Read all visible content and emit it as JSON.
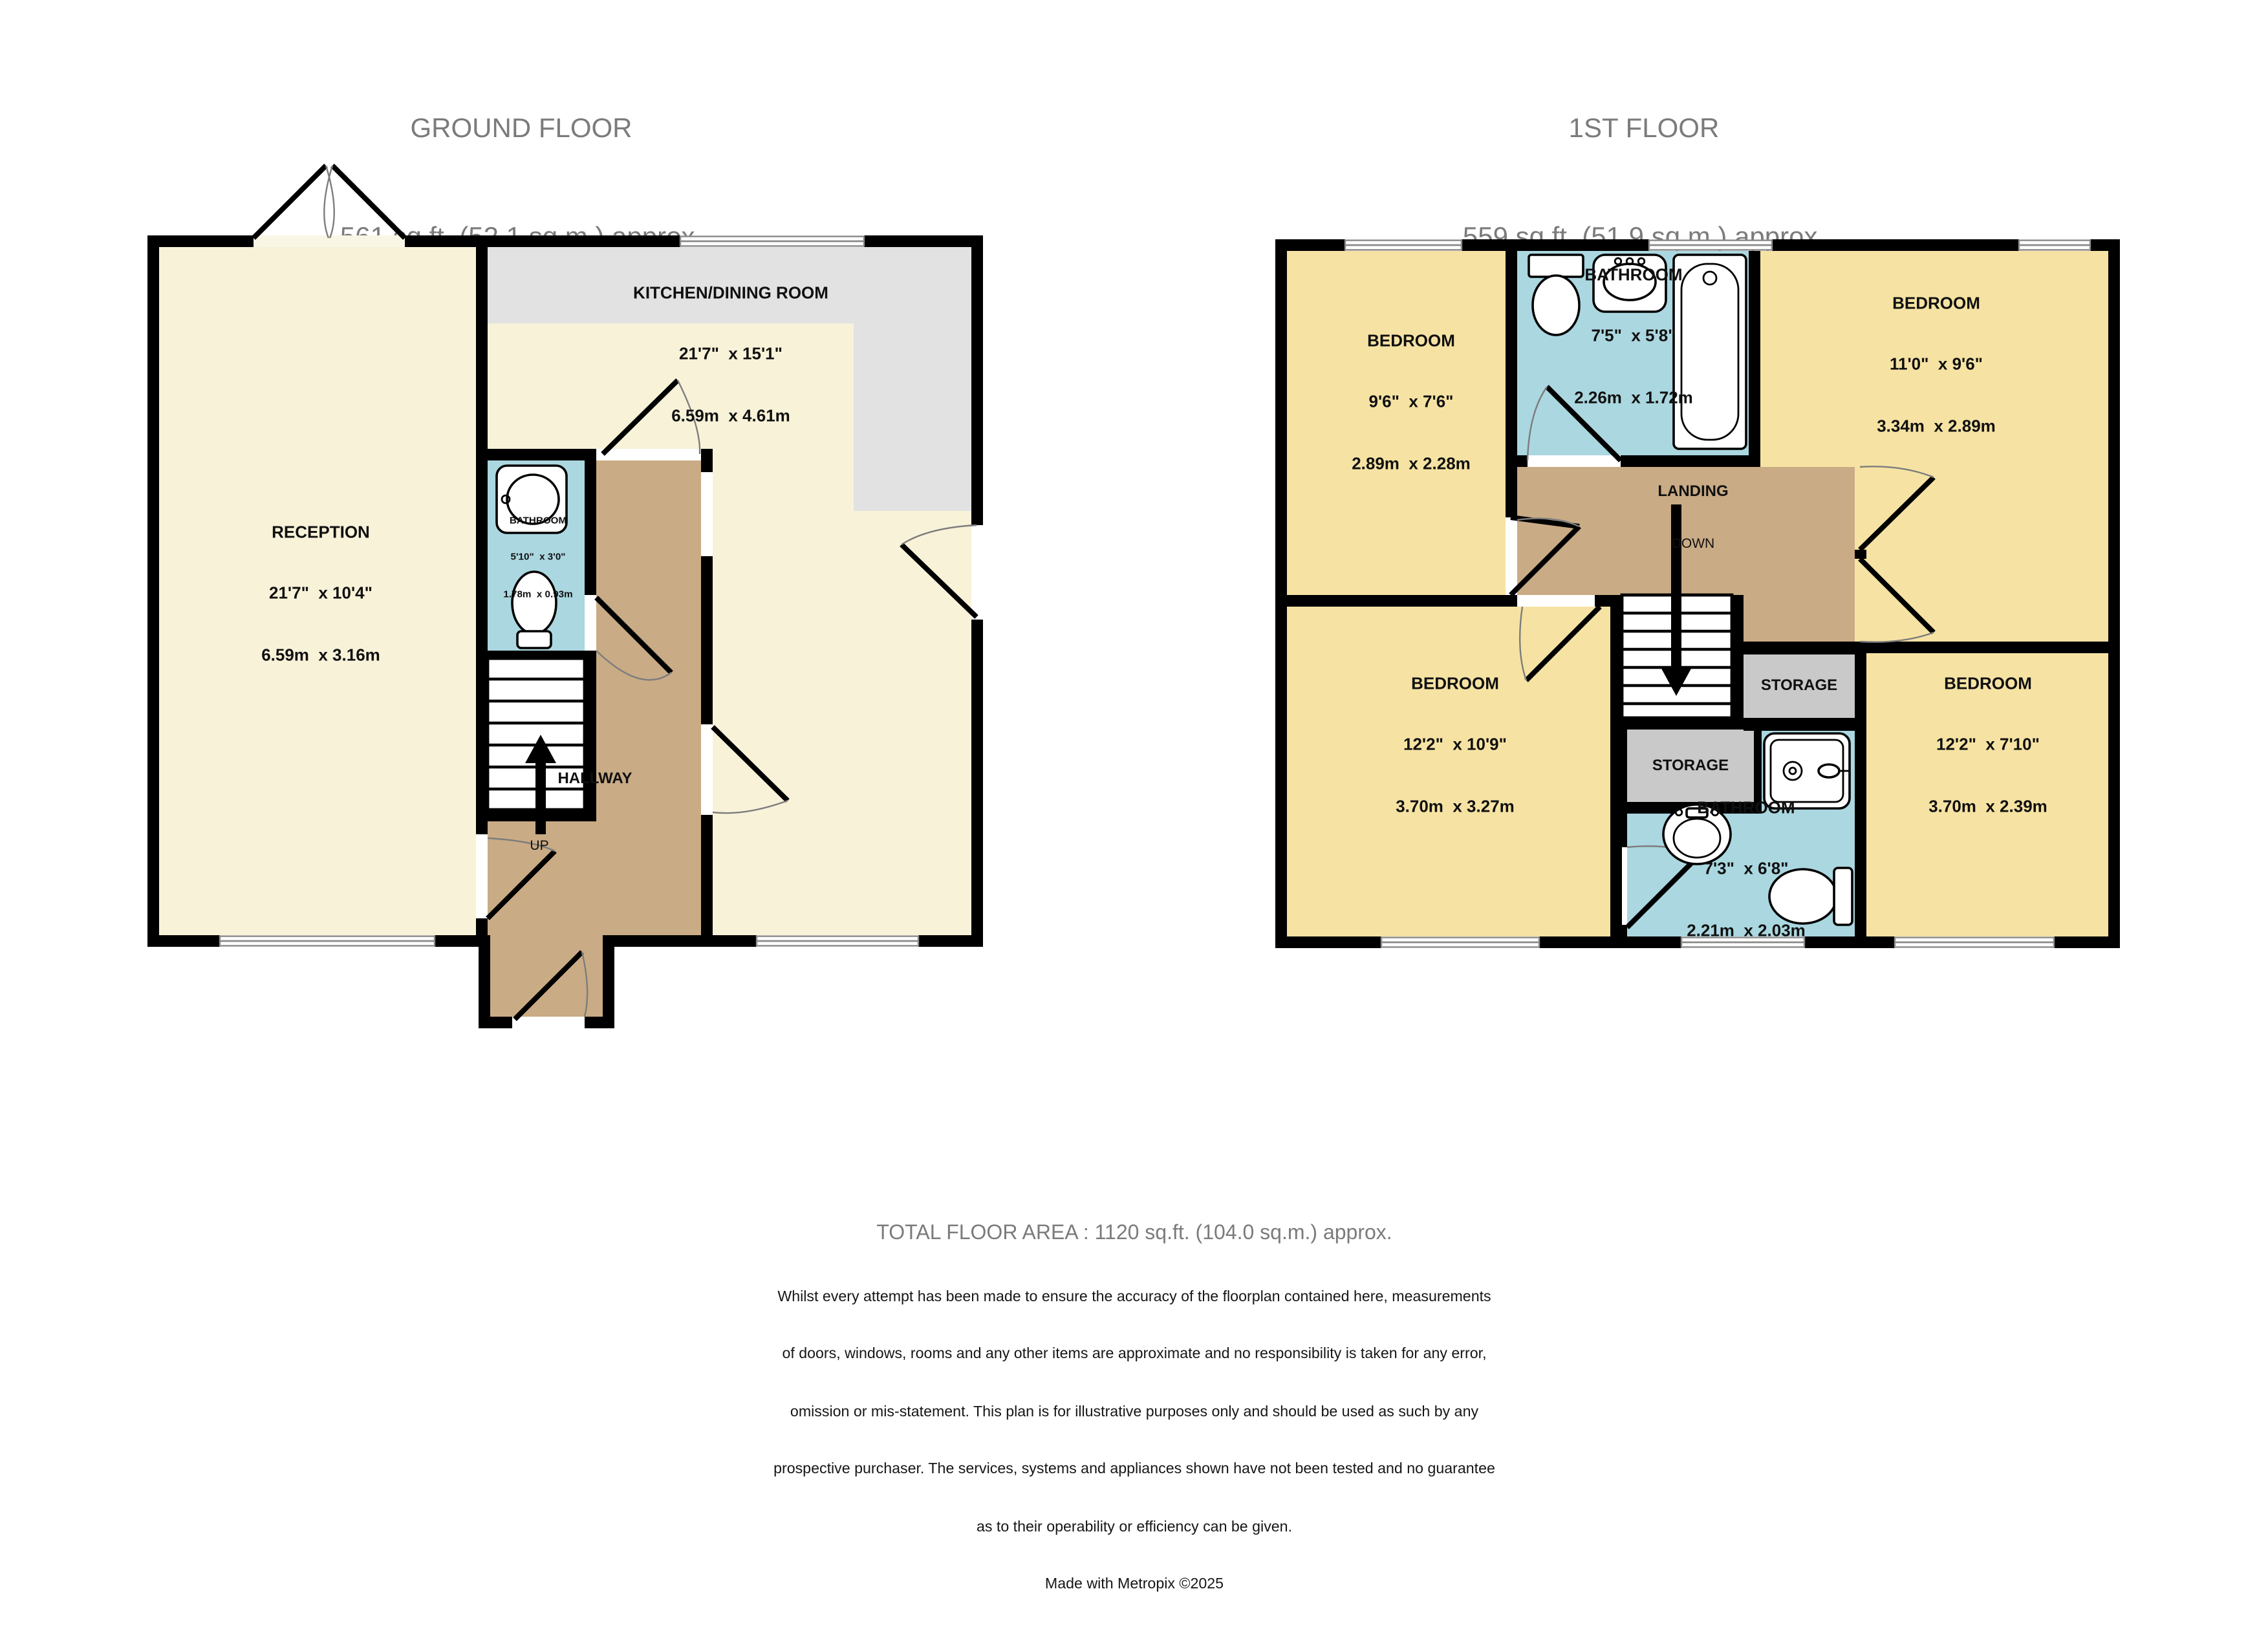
{
  "colors": {
    "wall": "#000000",
    "cream": "#f8f2d9",
    "cream-light": "#faf6e5",
    "yellow": "#f6e3a3",
    "blue": "#abd7e0",
    "tan": "#c9ab85",
    "storage-gray": "#c9c9c9",
    "counter-gray": "#e2e2e2",
    "title-gray": "#7b7b7b"
  },
  "ground_floor": {
    "title": "GROUND FLOOR",
    "subtitle": "561 sq.ft. (52.1 sq.m.) approx.",
    "reception": {
      "name": "RECEPTION",
      "dims_imperial": "21'7\"  x 10'4\"",
      "dims_metric": "6.59m  x 3.16m"
    },
    "kitchen": {
      "name": "KITCHEN/DINING ROOM",
      "dims_imperial": "21'7\"  x 15'1\"",
      "dims_metric": "6.59m  x 4.61m"
    },
    "bathroom": {
      "name": "BATHROOM",
      "dims_imperial": "5'10\"  x 3'0\"",
      "dims_metric": "1.78m  x 0.93m"
    },
    "hallway": {
      "name": "HALLWAY"
    },
    "stairs_label": "UP"
  },
  "first_floor": {
    "title": "1ST FLOOR",
    "subtitle": "559 sq.ft. (51.9 sq.m.) approx.",
    "bedroom_top_left": {
      "name": "BEDROOM",
      "dims_imperial": "9'6\"  x 7'6\"",
      "dims_metric": "2.89m  x 2.28m"
    },
    "bathroom_top": {
      "name": "BATHROOM",
      "dims_imperial": "7'5\"  x 5'8\"",
      "dims_metric": "2.26m  x 1.72m"
    },
    "bedroom_top_right": {
      "name": "BEDROOM",
      "dims_imperial": "11'0\"  x 9'6\"",
      "dims_metric": "3.34m  x 2.89m"
    },
    "landing": {
      "name": "LANDING",
      "stairs_label": "DOWN"
    },
    "bedroom_bottom_left": {
      "name": "BEDROOM",
      "dims_imperial": "12'2\"  x 10'9\"",
      "dims_metric": "3.70m  x 3.27m"
    },
    "bedroom_bottom_right": {
      "name": "BEDROOM",
      "dims_imperial": "12'2\"  x 7'10\"",
      "dims_metric": "3.70m  x 2.39m"
    },
    "storage_upper": {
      "name": "STORAGE"
    },
    "storage_lower": {
      "name": "STORAGE"
    },
    "bathroom_bottom": {
      "name": "BATHROOM",
      "dims_imperial": "7'3\"  x 6'8\"",
      "dims_metric": "2.21m  x 2.03m"
    }
  },
  "footer": {
    "total_area": "TOTAL FLOOR AREA : 1120 sq.ft. (104.0 sq.m.) approx.",
    "disclaimer_lines": [
      "Whilst every attempt has been made to ensure the accuracy of the floorplan contained here, measurements",
      "of doors, windows, rooms and any other items are approximate and no responsibility is taken for any error,",
      "omission or mis-statement. This plan is for illustrative purposes only and should be used as such by any",
      "prospective purchaser. The services, systems and appliances shown have not been tested and no guarantee",
      "as to their operability or efficiency can be given."
    ],
    "credit": "Made with Metropix ©2025"
  }
}
